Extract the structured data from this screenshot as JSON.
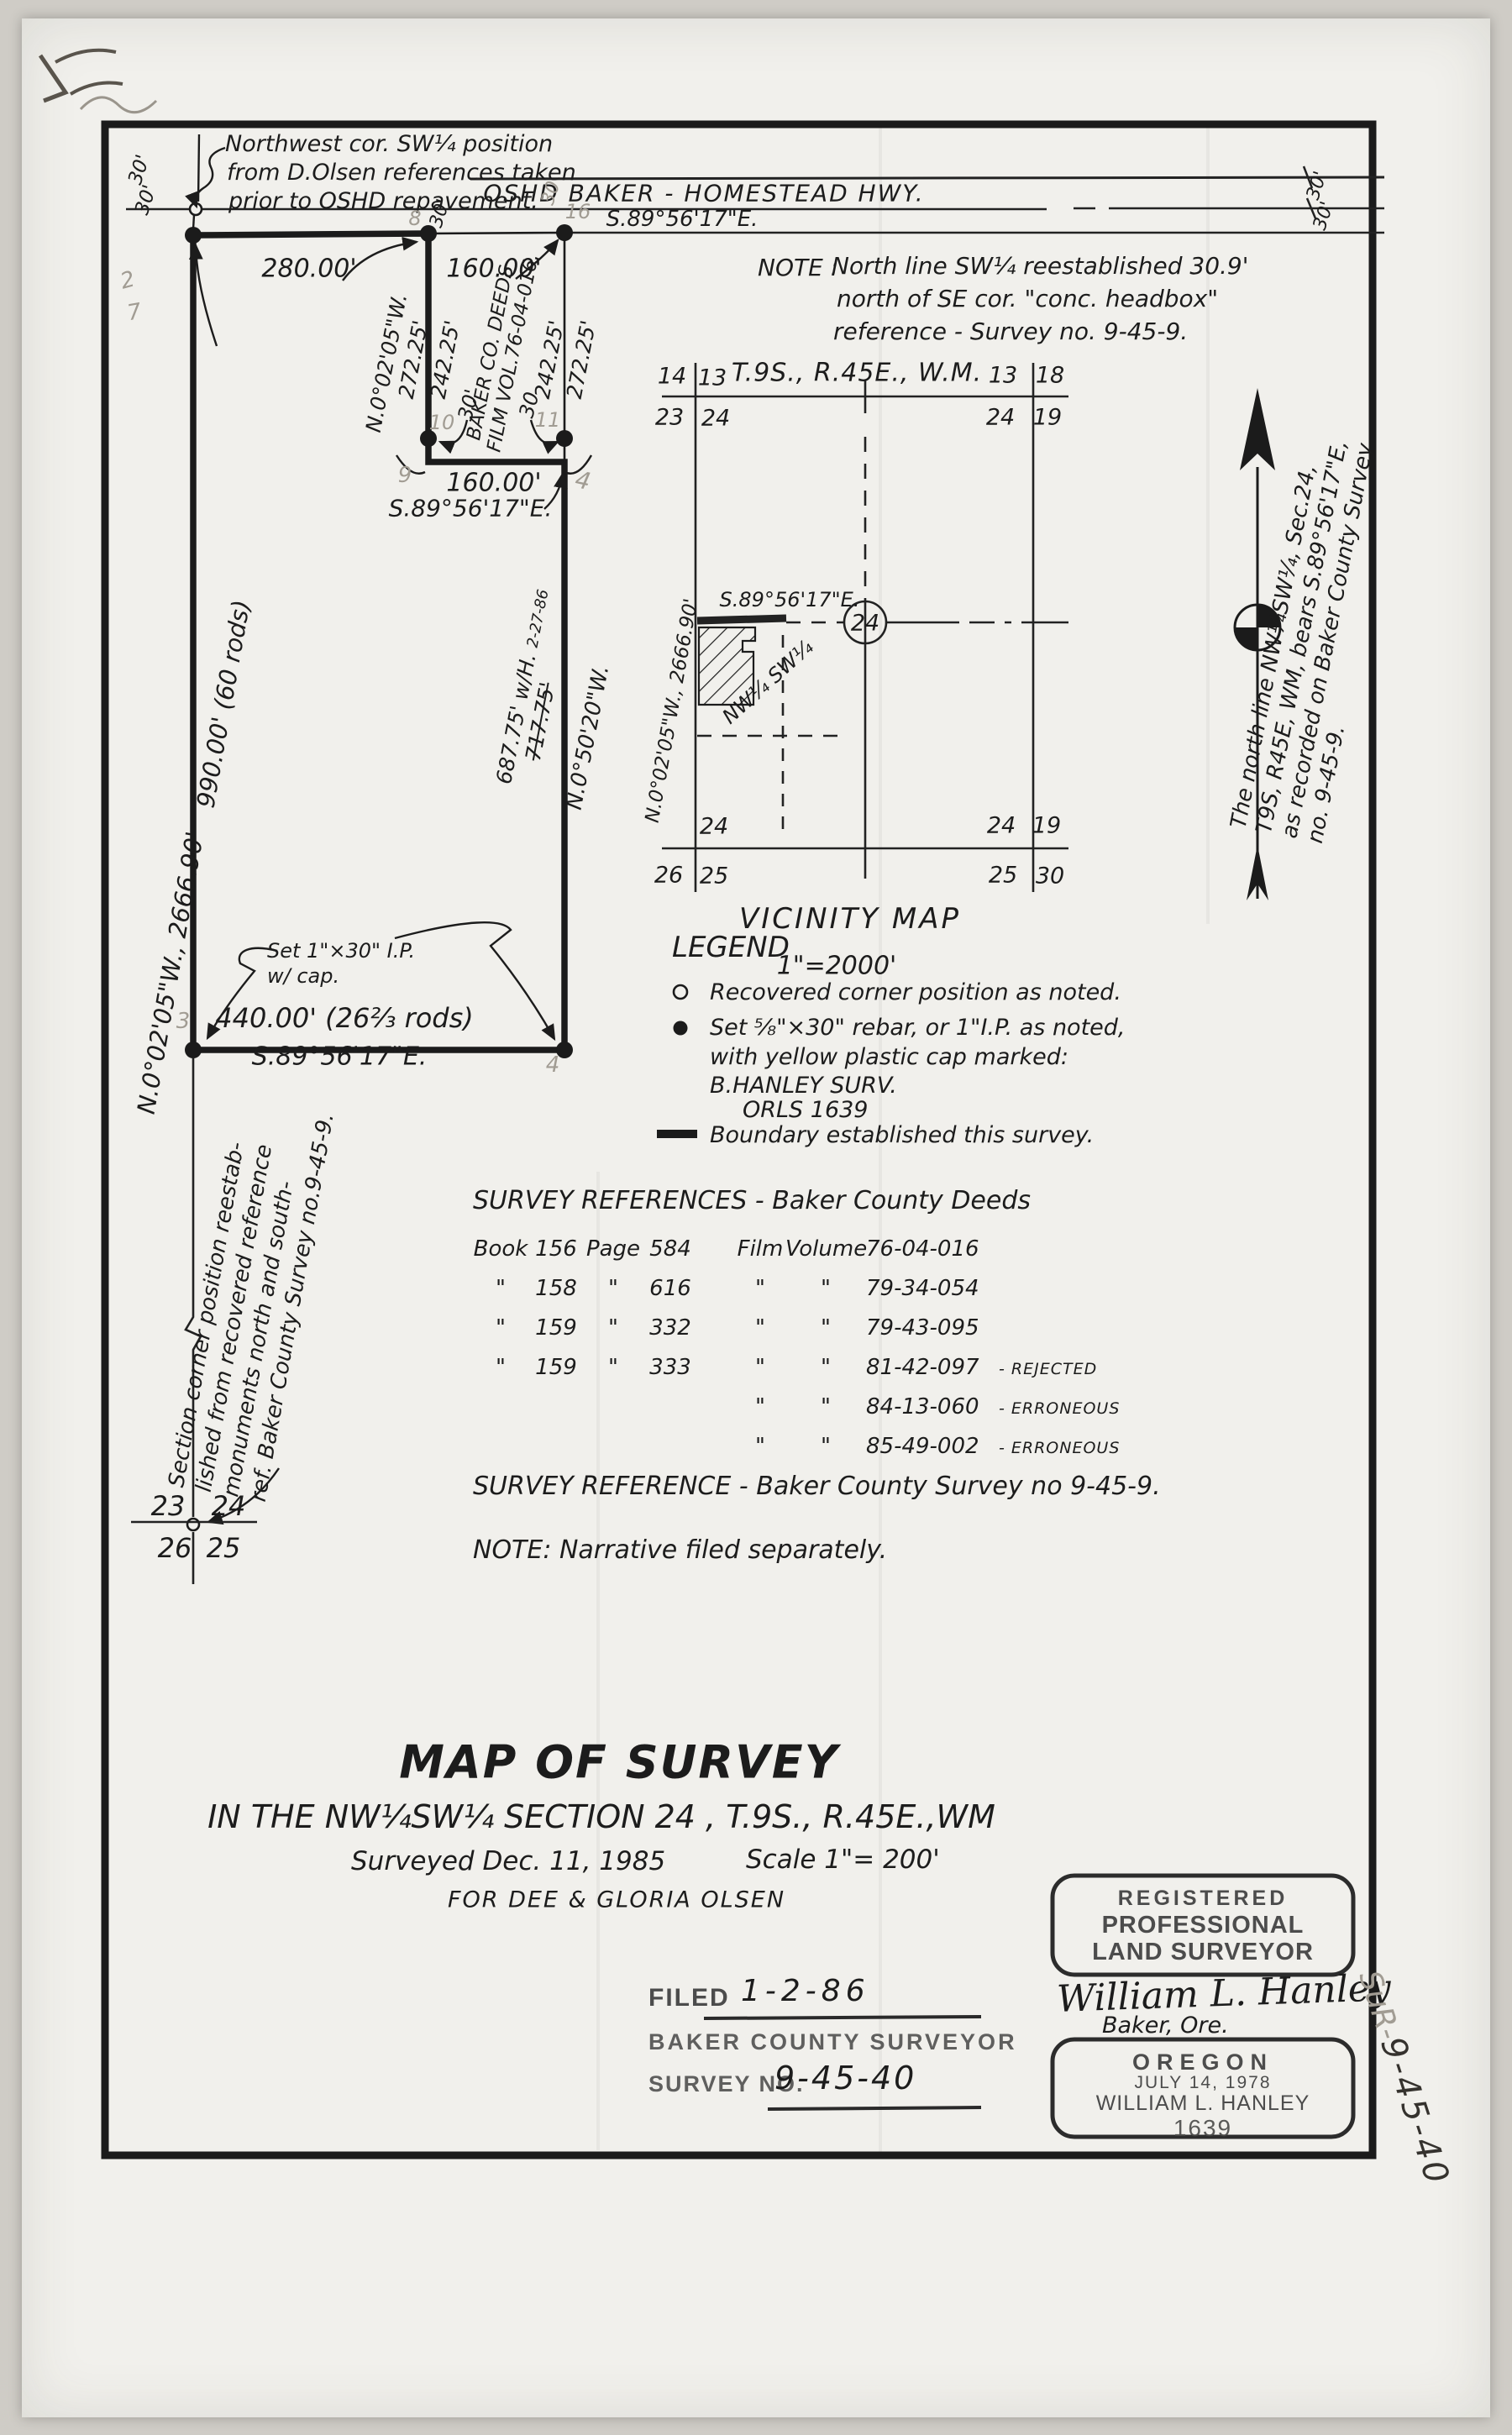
{
  "margin_label": {
    "prefix": "SuR-",
    "number": "9-45-40"
  },
  "nw_note": {
    "line1": "Northwest cor. SW¼ position",
    "line2": "from D.Olsen references taken",
    "line3": "prior to OSHD repavement."
  },
  "highway": {
    "name": "OSHD   BAKER - HOMESTEAD   HWY.",
    "bearing": "S.89°56'17\"E.",
    "offset_nw_a": "30'",
    "offset_nw_b": "30'",
    "offset_top_b": "30'",
    "offset_top_c": "30",
    "offset_e_a": "30'",
    "offset_e_b": "30'"
  },
  "ne_note": {
    "label": "NOTE :",
    "line1": "North line SW¼ reestablished 30.9'",
    "line2": "north of SE cor. \"conc. headbox\"",
    "line3": "reference - Survey no. 9-45-9."
  },
  "parcel": {
    "top_280": "280.00'",
    "top_160": "160.00'",
    "w_bearing": "N.0°02'05\"W.",
    "w_272": "272.25'",
    "w_242": "242.25'",
    "deeds_1": "BAKER CO. DEEDS",
    "deeds_2": "FILM VOL.76-04-016.",
    "e_242": "242.25'",
    "e_272": "272.25'",
    "jog_30w": "30'",
    "jog_30e": "30",
    "jog_160": "160.00'",
    "jog_bearing": "S.89°56'17\"E.",
    "east_687": "687.75' w/H.",
    "east_687_date": "2-27-86",
    "east_717": "717.75'",
    "east_bearing": "N.0°50'20\"W.",
    "west_990": "990.00'   (60 rods)",
    "west_bearing": "N.0°02'05\"W.,  2666.90'",
    "south_440": "440.00'    (26⅔ rods)",
    "south_bearing": "S.89°56'17\"E.",
    "set_ip_1": "Set 1\"×30\" I.P.",
    "set_ip_2": "w/ cap."
  },
  "pencil_marks": {
    "m2": "2",
    "m7": "7",
    "m8": "8",
    "m16": "16",
    "m10": "10",
    "m11": "11",
    "m9": "9",
    "m4a": "4",
    "m3": "3",
    "m4b": "4"
  },
  "corner_note": {
    "line1": "Section corner position reestab-",
    "line2": "lished from recovered reference",
    "line3": "monuments north and south-",
    "line4": "ref. Baker County Survey no.9-45-9."
  },
  "section_corner": {
    "nw": "23",
    "ne": "24",
    "sw": "26",
    "se": "25"
  },
  "north_note": {
    "line1": "The north line NW¼SW¼, Sec.24,",
    "line2": "T9S, R45E, WM, bears S.89°56'17\"E,",
    "line3": "as recorded on Baker County Survey",
    "line4": "no. 9-45-9."
  },
  "vicinity": {
    "township": "T.9S., R.45E., W.M.",
    "nw_a": "14",
    "nw_b": "13",
    "nw_c": "23",
    "nw_d": "24",
    "ne_a": "13",
    "ne_b": "18",
    "ne_c": "24",
    "ne_d": "19",
    "sw_a": "24",
    "sw_c": "26",
    "sw_d": "25",
    "se_a": "24",
    "se_b": "19",
    "se_c": "25",
    "se_d": "30",
    "bearing": "S.89°56'17\"E.",
    "sec24": "24",
    "parcel_label": "NW¼ SW¼",
    "west_line": "N.0°02'05\"W., 2666.90'",
    "title": "VICINITY   MAP",
    "scale": "1\"=2000'"
  },
  "legend": {
    "title": "LEGEND",
    "item1": "Recovered corner position as noted.",
    "item2a": "Set ⅝\"×30\" rebar, or 1\"I.P. as noted,",
    "item2b": "with yellow plastic cap marked:",
    "item2c": "B.HANLEY SURV.",
    "item2d": "ORLS 1639",
    "item3": "Boundary established this survey."
  },
  "references": {
    "title": "SURVEY REFERENCES  - Baker County Deeds",
    "rows": [
      {
        "book_l": "Book",
        "book": "156",
        "page_l": "Page",
        "page": "584",
        "film_l": "Film",
        "vol_l": "Volume",
        "num": "76-04-016",
        "suffix": ""
      },
      {
        "book_l": "\"",
        "book": "158",
        "page_l": "\"",
        "page": "616",
        "film_l": "\"",
        "vol_l": "\"",
        "num": "79-34-054",
        "suffix": ""
      },
      {
        "book_l": "\"",
        "book": "159",
        "page_l": "\"",
        "page": "332",
        "film_l": "\"",
        "vol_l": "\"",
        "num": "79-43-095",
        "suffix": ""
      },
      {
        "book_l": "\"",
        "book": "159",
        "page_l": "\"",
        "page": "333",
        "film_l": "\"",
        "vol_l": "\"",
        "num": "81-42-097",
        "suffix": "- REJECTED"
      },
      {
        "book_l": "",
        "book": "",
        "page_l": "",
        "page": "",
        "film_l": "\"",
        "vol_l": "\"",
        "num": "84-13-060",
        "suffix": "- ERRONEOUS"
      },
      {
        "book_l": "",
        "book": "",
        "page_l": "",
        "page": "",
        "film_l": "\"",
        "vol_l": "\"",
        "num": "85-49-002",
        "suffix": "- ERRONEOUS"
      }
    ],
    "single": "SURVEY REFERENCE - Baker County Survey no 9-45-9.",
    "note": "NOTE: Narrative filed separately."
  },
  "title_block": {
    "title": "MAP OF SURVEY",
    "subtitle": "IN THE NW¼SW¼ SECTION 24 , T.9S., R.45E.,WM",
    "surveyed": "Surveyed Dec. 11, 1985",
    "scale": "Scale 1\"= 200'",
    "client": "FOR DEE & GLORIA OLSEN"
  },
  "filed": {
    "filed_label": "FILED",
    "date": "1-2-86",
    "surveyor": "BAKER COUNTY SURVEYOR",
    "survey_no_label": "SURVEY NO.",
    "survey_no": "9-45-40"
  },
  "stamp": {
    "l1": "REGISTERED",
    "l2": "PROFESSIONAL",
    "l3": "LAND SURVEYOR",
    "signature": "William L. Hanley",
    "city": "Baker, Ore.",
    "state": "OREGON",
    "date": "JULY 14, 1978",
    "name": "WILLIAM L. HANLEY",
    "number": "1639"
  }
}
